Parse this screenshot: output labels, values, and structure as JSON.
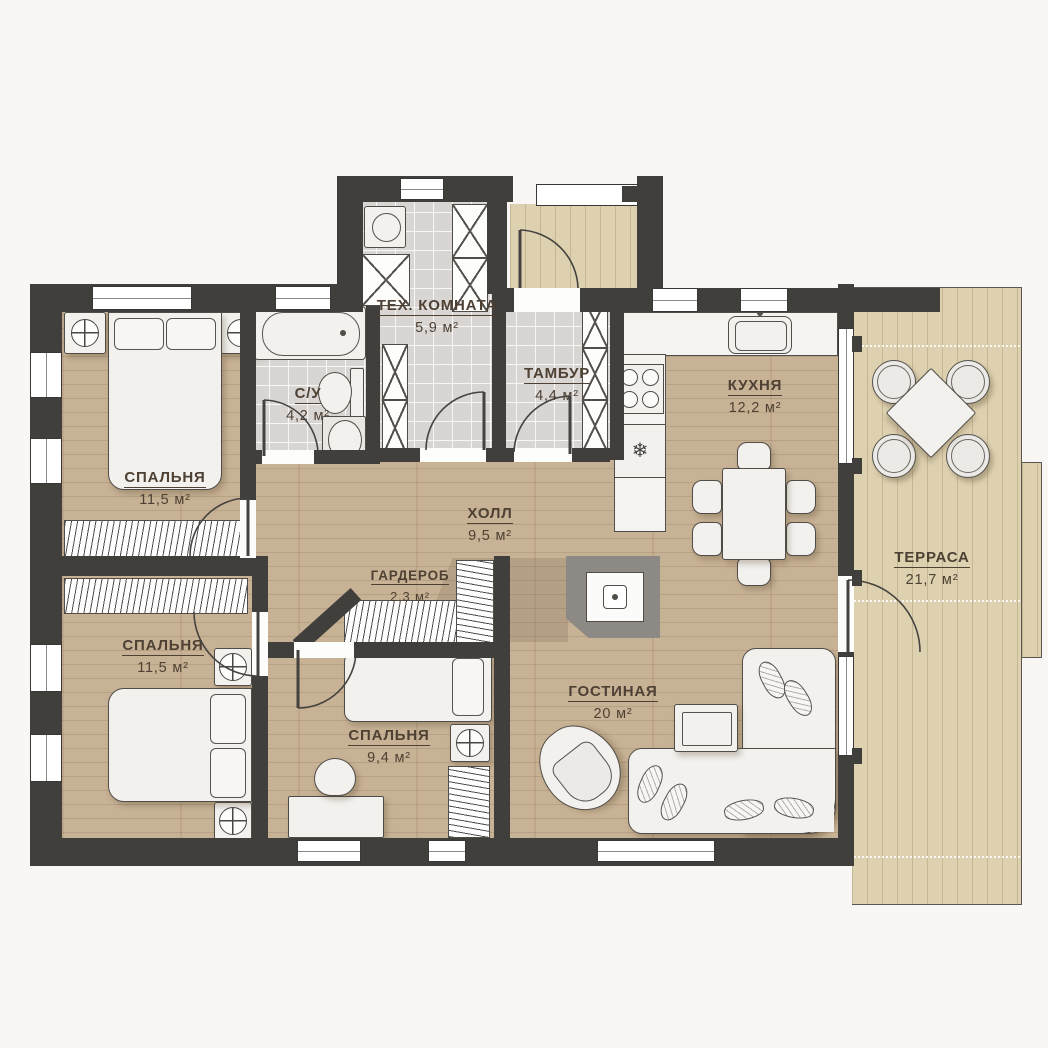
{
  "plan": {
    "unit": "м²",
    "rooms": [
      {
        "id": "bedroom-1",
        "name": "СПАЛЬНЯ",
        "area": "11,5 м²"
      },
      {
        "id": "bathroom",
        "name": "С/У",
        "area": "4,2 м²"
      },
      {
        "id": "tech-room",
        "name": "ТЕХ. КОМНАТА",
        "area": "5,9 м²"
      },
      {
        "id": "tambour",
        "name": "ТАМБУР",
        "area": "4,4 м²"
      },
      {
        "id": "kitchen",
        "name": "КУХНЯ",
        "area": "12,2 м²"
      },
      {
        "id": "hall",
        "name": "ХОЛЛ",
        "area": "9,5 м²"
      },
      {
        "id": "terrace",
        "name": "ТЕРРАСА",
        "area": "21,7 м²"
      },
      {
        "id": "wardrobe",
        "name": "ГАРДЕРОБ",
        "area": "2,3 м²"
      },
      {
        "id": "bedroom-2",
        "name": "СПАЛЬНЯ",
        "area": "11,5 м²"
      },
      {
        "id": "bedroom-3",
        "name": "СПАЛЬНЯ",
        "area": "9,4 м²"
      },
      {
        "id": "living-room",
        "name": "ГОСТИНАЯ",
        "area": "20 м²"
      }
    ],
    "icons": {
      "snowflake": "❄"
    },
    "colors": {
      "wall": "#413f3c",
      "wood_floor": "#c8b295",
      "tile_floor": "#d8d5d2",
      "terrace_deck": "#ddd1b0",
      "furniture": "#f2f1ee"
    }
  }
}
